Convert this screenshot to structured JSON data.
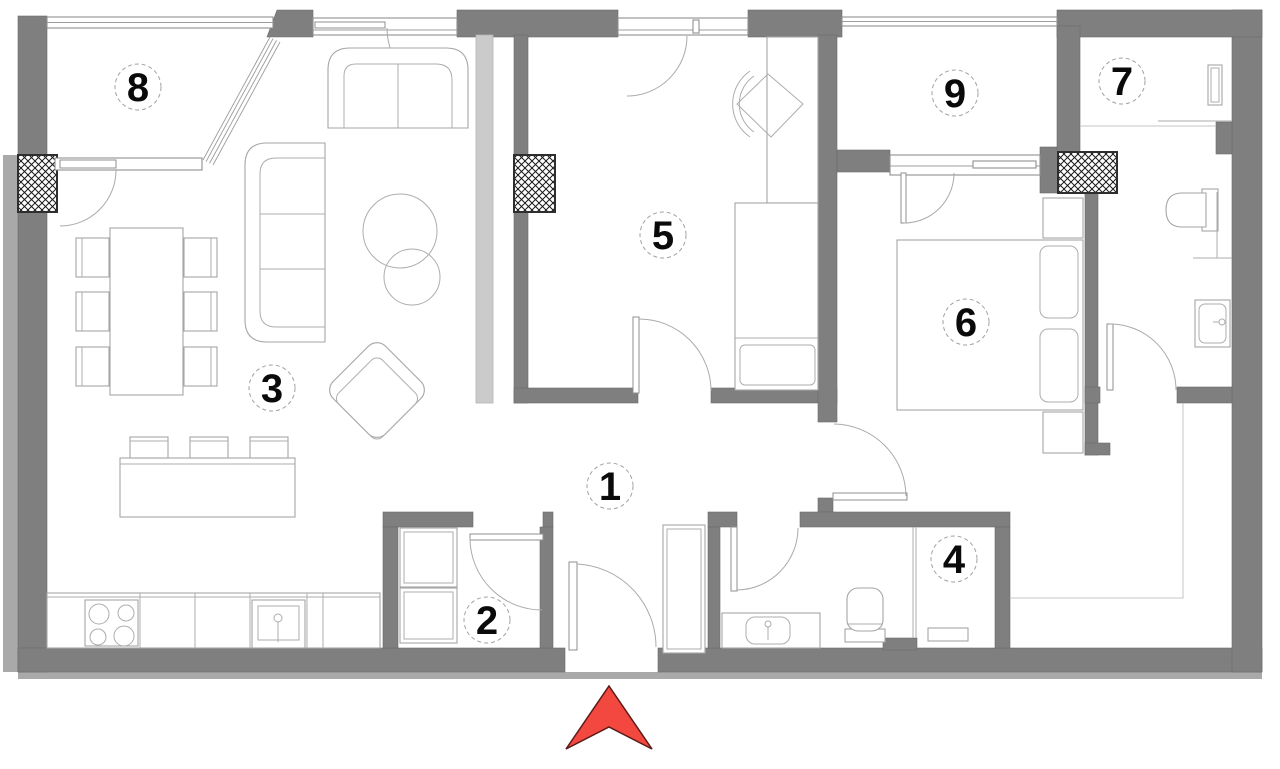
{
  "plan": {
    "type": "apartment-floor-plan",
    "rooms": [
      {
        "number": "1",
        "cx": 610,
        "cy": 486
      },
      {
        "number": "2",
        "cx": 487,
        "cy": 620
      },
      {
        "number": "3",
        "cx": 272,
        "cy": 388
      },
      {
        "number": "4",
        "cx": 954,
        "cy": 559
      },
      {
        "number": "5",
        "cx": 663,
        "cy": 235
      },
      {
        "number": "6",
        "cx": 966,
        "cy": 322
      },
      {
        "number": "7",
        "cx": 1122,
        "cy": 81
      },
      {
        "number": "8",
        "cx": 138,
        "cy": 87
      },
      {
        "number": "9",
        "cx": 955,
        "cy": 93
      }
    ],
    "entrance": {
      "symbol": "arrow",
      "direction": "up"
    },
    "colors": {
      "wall": "#7f7f7f",
      "arrow": "#f2483f",
      "arrow_outline": "#5a1a17",
      "label_text": "#0a0a0a",
      "label_ring": "#a0a0a0",
      "furniture_line": "#a5a5a5",
      "window_line": "#8f8f8f",
      "hatch_line": "#1a1a1a"
    }
  }
}
